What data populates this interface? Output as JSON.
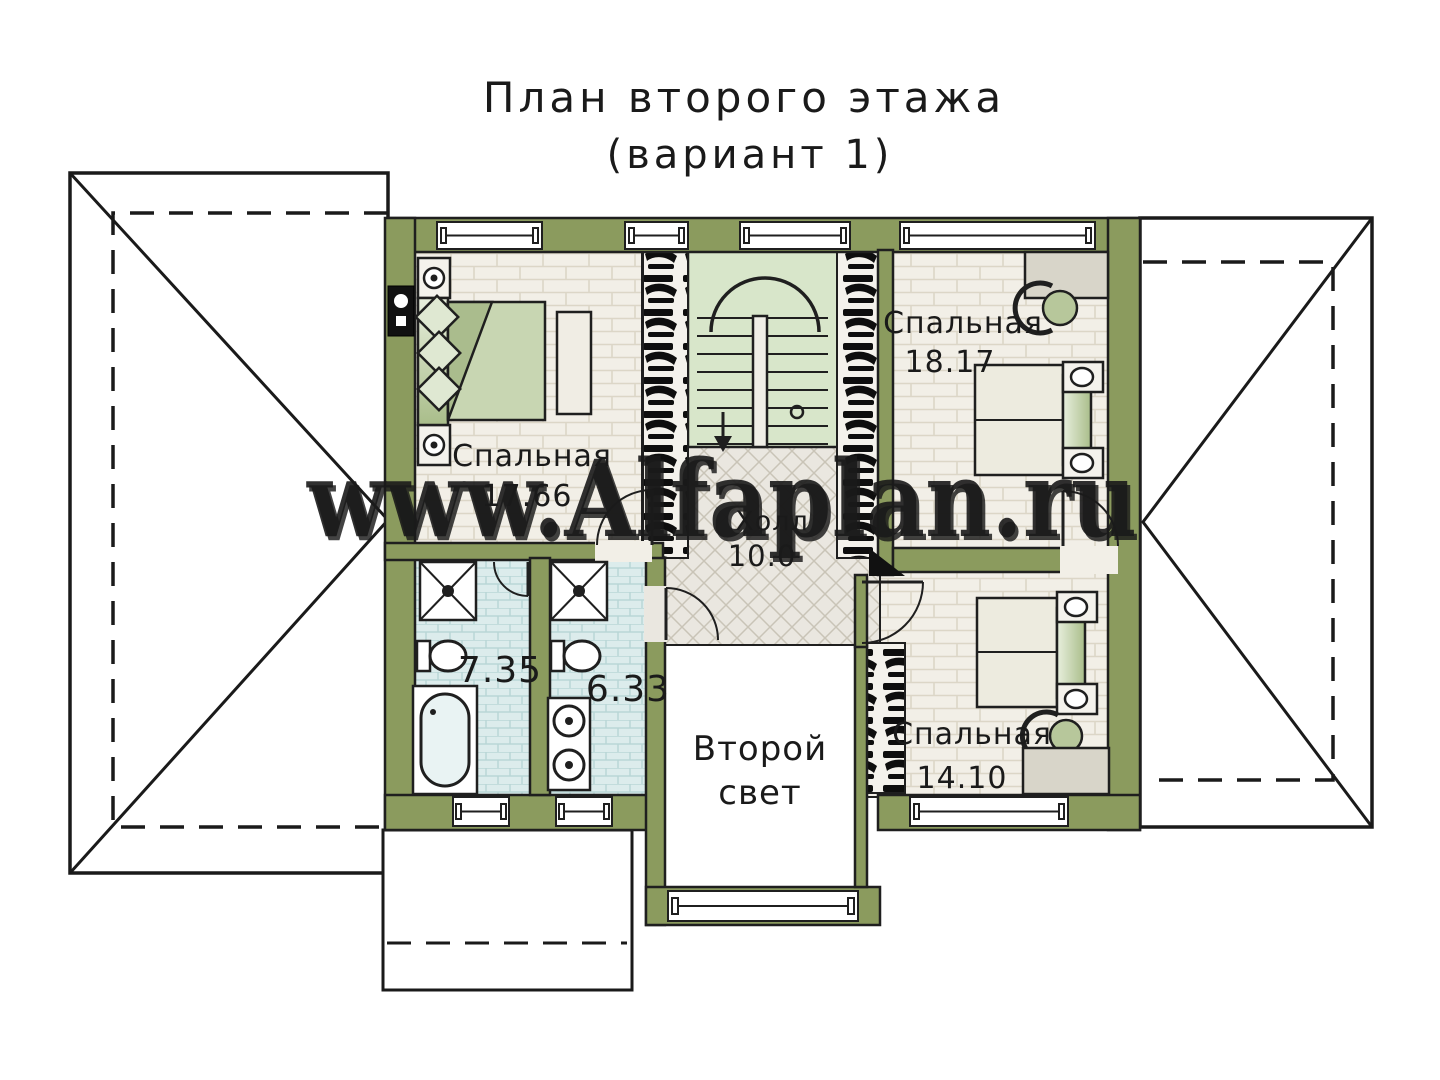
{
  "title": {
    "line1": "План второго этажа",
    "line2": "(вариант 1)"
  },
  "watermark": {
    "text": "www.Alfaplan.ru"
  },
  "rooms": {
    "bedroom_top_left": {
      "name": "Спальная",
      "area": "17.66"
    },
    "bedroom_top_right": {
      "name": "Спальная",
      "area": "18.17"
    },
    "bedroom_bottom_right": {
      "name": "Спальная",
      "area": "14.10"
    },
    "bathroom_left": {
      "area": "7.35"
    },
    "bathroom_right": {
      "area": "6.33"
    },
    "hall": {
      "name": "Холл",
      "area": "10.0"
    },
    "second_light": {
      "line1": "Второй",
      "line2": "свет"
    }
  },
  "colors": {
    "wall_olive": "#8b9b5e",
    "room_floor": "#f2efe7",
    "bath_floor": "#dcecec",
    "hall_floor": "#eae7e0",
    "stair_floor": "#d8e6ca",
    "furniture_green": "#c8d6b2",
    "furniture_gray": "#d8d5c9",
    "line_black": "#1f1f1f",
    "watermark_gray": "#a2a2a0"
  }
}
